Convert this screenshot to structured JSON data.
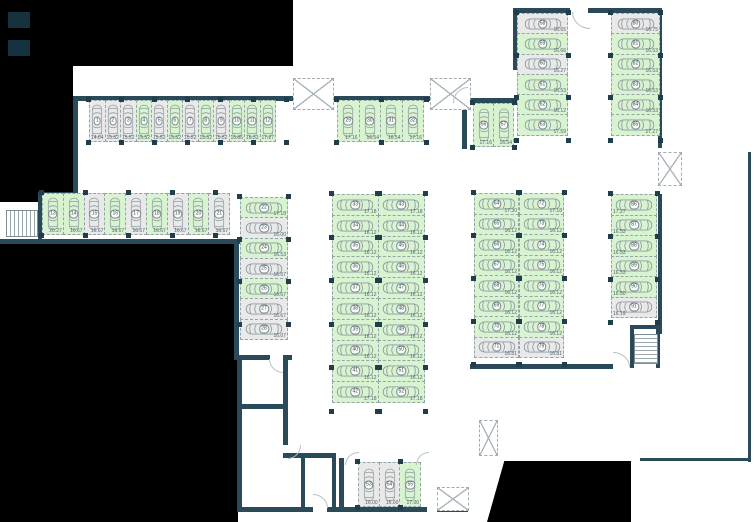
{
  "colors": {
    "free": "#d8f3cf",
    "occupied": "#e9e9e9",
    "wall": "#2b4a59",
    "void": "#000000",
    "dimension_text": "#53646c"
  },
  "groups": {
    "r1": {
      "label": "spaces 1-12",
      "spaces": [
        {
          "n": "1",
          "a": "14.04",
          "s": "occupied"
        },
        {
          "n": "2",
          "a": "15.52",
          "s": "occupied"
        },
        {
          "n": "3",
          "a": "15.52",
          "s": "occupied"
        },
        {
          "n": "4",
          "a": "15.52",
          "s": "free"
        },
        {
          "n": "5",
          "a": "15.52",
          "s": "occupied"
        },
        {
          "n": "6",
          "a": "15.52",
          "s": "free"
        },
        {
          "n": "7",
          "a": "15.52",
          "s": "occupied"
        },
        {
          "n": "8",
          "a": "15.52",
          "s": "free"
        },
        {
          "n": "9",
          "a": "15.52",
          "s": "occupied"
        },
        {
          "n": "10",
          "a": "16.86",
          "s": "free"
        },
        {
          "n": "11",
          "a": "16.33",
          "s": "free"
        },
        {
          "n": "12",
          "a": "17.27",
          "s": "free"
        }
      ]
    },
    "r2": {
      "label": "spaces 29-32",
      "spaces": [
        {
          "n": "29",
          "a": "17.16",
          "s": "free"
        },
        {
          "n": "30",
          "a": "16.54",
          "s": "free"
        },
        {
          "n": "31",
          "a": "16.54",
          "s": "free"
        },
        {
          "n": "32",
          "a": "17.16",
          "s": "free"
        }
      ]
    },
    "r3": {
      "label": "spaces 56-57",
      "spaces": [
        {
          "n": "56",
          "a": "17.16",
          "s": "free"
        },
        {
          "n": "57",
          "a": "16.54",
          "s": "free"
        }
      ]
    },
    "r4": {
      "label": "spaces 13-21",
      "spaces": [
        {
          "n": "13",
          "a": "20.27",
          "s": "free"
        },
        {
          "n": "14",
          "a": "16.67",
          "s": "free"
        },
        {
          "n": "15",
          "a": "16.67",
          "s": "occupied"
        },
        {
          "n": "16",
          "a": "16.67",
          "s": "free"
        },
        {
          "n": "17",
          "a": "16.67",
          "s": "occupied"
        },
        {
          "n": "18",
          "a": "16.67",
          "s": "free"
        },
        {
          "n": "19",
          "a": "16.67",
          "s": "occupied"
        },
        {
          "n": "20",
          "a": "16.67",
          "s": "free"
        },
        {
          "n": "21",
          "a": "16.67",
          "s": "occupied"
        }
      ]
    },
    "c1": {
      "label": "spaces 22-28",
      "spaces": [
        {
          "n": "22",
          "a": "17.18",
          "s": "free"
        },
        {
          "n": "23",
          "a": "16.00",
          "s": "occupied"
        },
        {
          "n": "24",
          "a": "16.53",
          "s": "free"
        },
        {
          "n": "25",
          "a": "16.67",
          "s": "occupied"
        },
        {
          "n": "26",
          "a": "16.67",
          "s": "free"
        },
        {
          "n": "27",
          "a": "16.67",
          "s": "occupied"
        },
        {
          "n": "28",
          "a": "16.07",
          "s": "occupied"
        }
      ]
    },
    "ml": {
      "label": "spaces 33-42",
      "spaces": [
        {
          "n": "33",
          "a": "17.18",
          "s": "free"
        },
        {
          "n": "34",
          "a": "16.12",
          "s": "free"
        },
        {
          "n": "35",
          "a": "16.12",
          "s": "free"
        },
        {
          "n": "36",
          "a": "16.12",
          "s": "free"
        },
        {
          "n": "37",
          "a": "16.12",
          "s": "free"
        },
        {
          "n": "38",
          "a": "16.12",
          "s": "free"
        },
        {
          "n": "39",
          "a": "16.12",
          "s": "free"
        },
        {
          "n": "40",
          "a": "16.12",
          "s": "free"
        },
        {
          "n": "41",
          "a": "16.12",
          "s": "free"
        },
        {
          "n": "42",
          "a": "17.18",
          "s": "free"
        }
      ]
    },
    "mr": {
      "label": "spaces 43-52",
      "spaces": [
        {
          "n": "43",
          "a": "17.18",
          "s": "free"
        },
        {
          "n": "44",
          "a": "16.12",
          "s": "free"
        },
        {
          "n": "45",
          "a": "16.12",
          "s": "free"
        },
        {
          "n": "46",
          "a": "16.12",
          "s": "free"
        },
        {
          "n": "47",
          "a": "16.12",
          "s": "free"
        },
        {
          "n": "48",
          "a": "16.12",
          "s": "free"
        },
        {
          "n": "49",
          "a": "16.12",
          "s": "free"
        },
        {
          "n": "50",
          "a": "16.12",
          "s": "free"
        },
        {
          "n": "51",
          "a": "16.12",
          "s": "free"
        },
        {
          "n": "52",
          "a": "17.18",
          "s": "free"
        }
      ]
    },
    "rml": {
      "label": "spaces 64-71",
      "spaces": [
        {
          "n": "64",
          "a": "17.30",
          "s": "free"
        },
        {
          "n": "65",
          "a": "16.12",
          "s": "free"
        },
        {
          "n": "66",
          "a": "16.12",
          "s": "free"
        },
        {
          "n": "67",
          "a": "16.12",
          "s": "free"
        },
        {
          "n": "68",
          "a": "16.12",
          "s": "free"
        },
        {
          "n": "69",
          "a": "16.12",
          "s": "free"
        },
        {
          "n": "70",
          "a": "16.12",
          "s": "free"
        },
        {
          "n": "71",
          "a": "16.81",
          "s": "occupied"
        }
      ]
    },
    "rmr": {
      "label": "spaces 72-79",
      "spaces": [
        {
          "n": "72",
          "a": "17.18",
          "s": "free"
        },
        {
          "n": "73",
          "a": "16.12",
          "s": "free"
        },
        {
          "n": "74",
          "a": "16.12",
          "s": "free"
        },
        {
          "n": "75",
          "a": "16.12",
          "s": "free"
        },
        {
          "n": "76",
          "a": "16.12",
          "s": "free"
        },
        {
          "n": "77",
          "a": "16.12",
          "s": "free"
        },
        {
          "n": "78",
          "a": "16.12",
          "s": "free"
        },
        {
          "n": "79",
          "a": "16.81",
          "s": "occupied"
        }
      ]
    },
    "trl": {
      "label": "spaces 58-63",
      "spaces": [
        {
          "n": "58",
          "a": "16.65",
          "s": "occupied"
        },
        {
          "n": "59",
          "a": "16.66",
          "s": "free"
        },
        {
          "n": "60",
          "a": "16.27",
          "s": "occupied"
        },
        {
          "n": "61",
          "a": "16.53",
          "s": "free"
        },
        {
          "n": "62",
          "a": "16.12",
          "s": "free"
        },
        {
          "n": "63",
          "a": "17.59",
          "s": "free"
        }
      ]
    },
    "trr": {
      "label": "spaces 80-85",
      "spaces": [
        {
          "n": "80",
          "a": "16.75",
          "s": "occupied"
        },
        {
          "n": "81",
          "a": "16.53",
          "s": "free"
        },
        {
          "n": "82",
          "a": "16.53",
          "s": "free"
        },
        {
          "n": "83",
          "a": "16.53",
          "s": "free"
        },
        {
          "n": "84",
          "a": "16.53",
          "s": "free"
        },
        {
          "n": "85",
          "a": "17.27",
          "s": "free"
        }
      ]
    },
    "fr": {
      "label": "spaces 86-91",
      "spaces": [
        {
          "n": "86",
          "a": "17.27",
          "s": "free"
        },
        {
          "n": "87",
          "a": "16.53",
          "s": "free"
        },
        {
          "n": "88",
          "a": "16.53",
          "s": "free"
        },
        {
          "n": "89",
          "a": "16.53",
          "s": "free"
        },
        {
          "n": "90",
          "a": "16.50",
          "s": "free"
        },
        {
          "n": "91",
          "a": "16.19",
          "s": "occupied"
        }
      ]
    },
    "b": {
      "label": "spaces 53-55",
      "spaces": [
        {
          "n": "53",
          "a": "16.00",
          "s": "occupied"
        },
        {
          "n": "54",
          "a": "16.00",
          "s": "occupied"
        },
        {
          "n": "55",
          "a": "17.00",
          "s": "free"
        }
      ]
    }
  }
}
